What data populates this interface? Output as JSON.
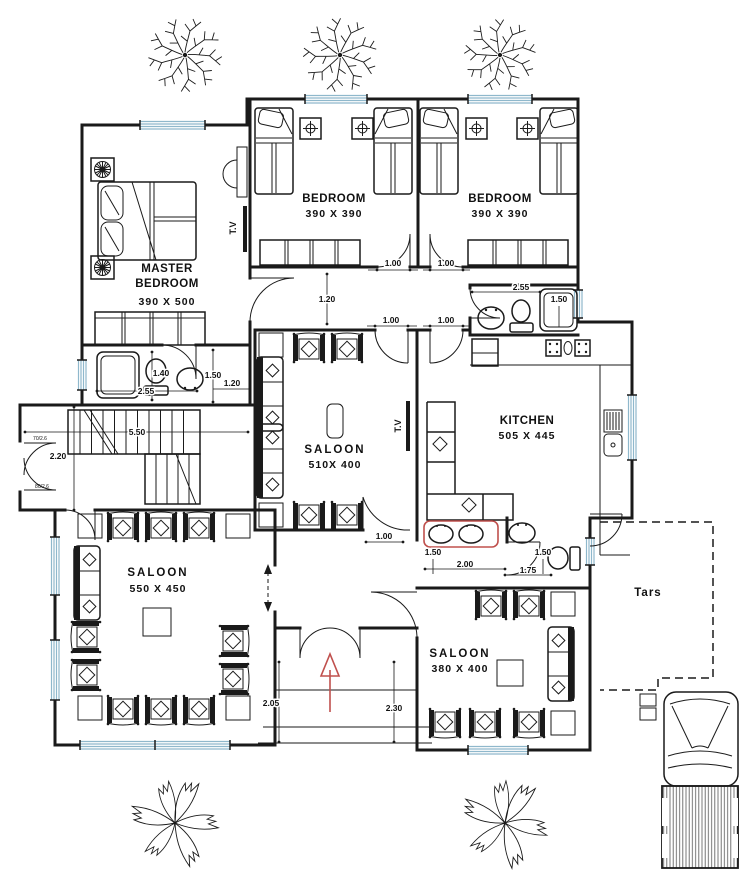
{
  "colors": {
    "wall": "#1a1a1a",
    "window_glass": "#8fb8cc",
    "entrance_arrow": "#c0504d",
    "counter_accent": "#c0504d"
  },
  "rooms": {
    "master_bedroom": {
      "line1": "MASTER",
      "line2": "BEDROOM",
      "size": "390 X 500"
    },
    "bedroom_left": {
      "name": "BEDROOM",
      "size": "390 X 390"
    },
    "bedroom_right": {
      "name": "BEDROOM",
      "size": "390 X 390"
    },
    "saloon_center": {
      "name": "SALOON",
      "size": "510X 400"
    },
    "kitchen": {
      "name": "KITCHEN",
      "size": "505 X 445"
    },
    "saloon_left": {
      "name": "SALOON",
      "size": "550 X 450"
    },
    "saloon_front": {
      "name": "SALOON",
      "size": "380 X 400"
    },
    "terrace": {
      "name": "Tars"
    }
  },
  "labels": {
    "tv": "T.V"
  },
  "dims": {
    "bedroom1_door": "1.00",
    "bedroom2_door": "1.00",
    "bath_width": "2.55",
    "bath_shower": "1.50",
    "hall_height": "1.20",
    "saloon_door": "1.00",
    "kitchen_door": "1.00",
    "mbath_a": "1.40",
    "mbath_b": "2.55",
    "mbath_c": "1.50",
    "mbath_d": "1.20",
    "stairs_length": "5.50",
    "stairs_width": "2.20",
    "wc_door": "1.00",
    "wc_a": "1.50",
    "wc_b": "2.00",
    "wc_c": "1.50",
    "wc_d": "1.75",
    "porch_a": "2.05",
    "porch_b": "2.30"
  },
  "door_tags": {
    "top": "70/2.6",
    "bottom": "80/2.6"
  }
}
